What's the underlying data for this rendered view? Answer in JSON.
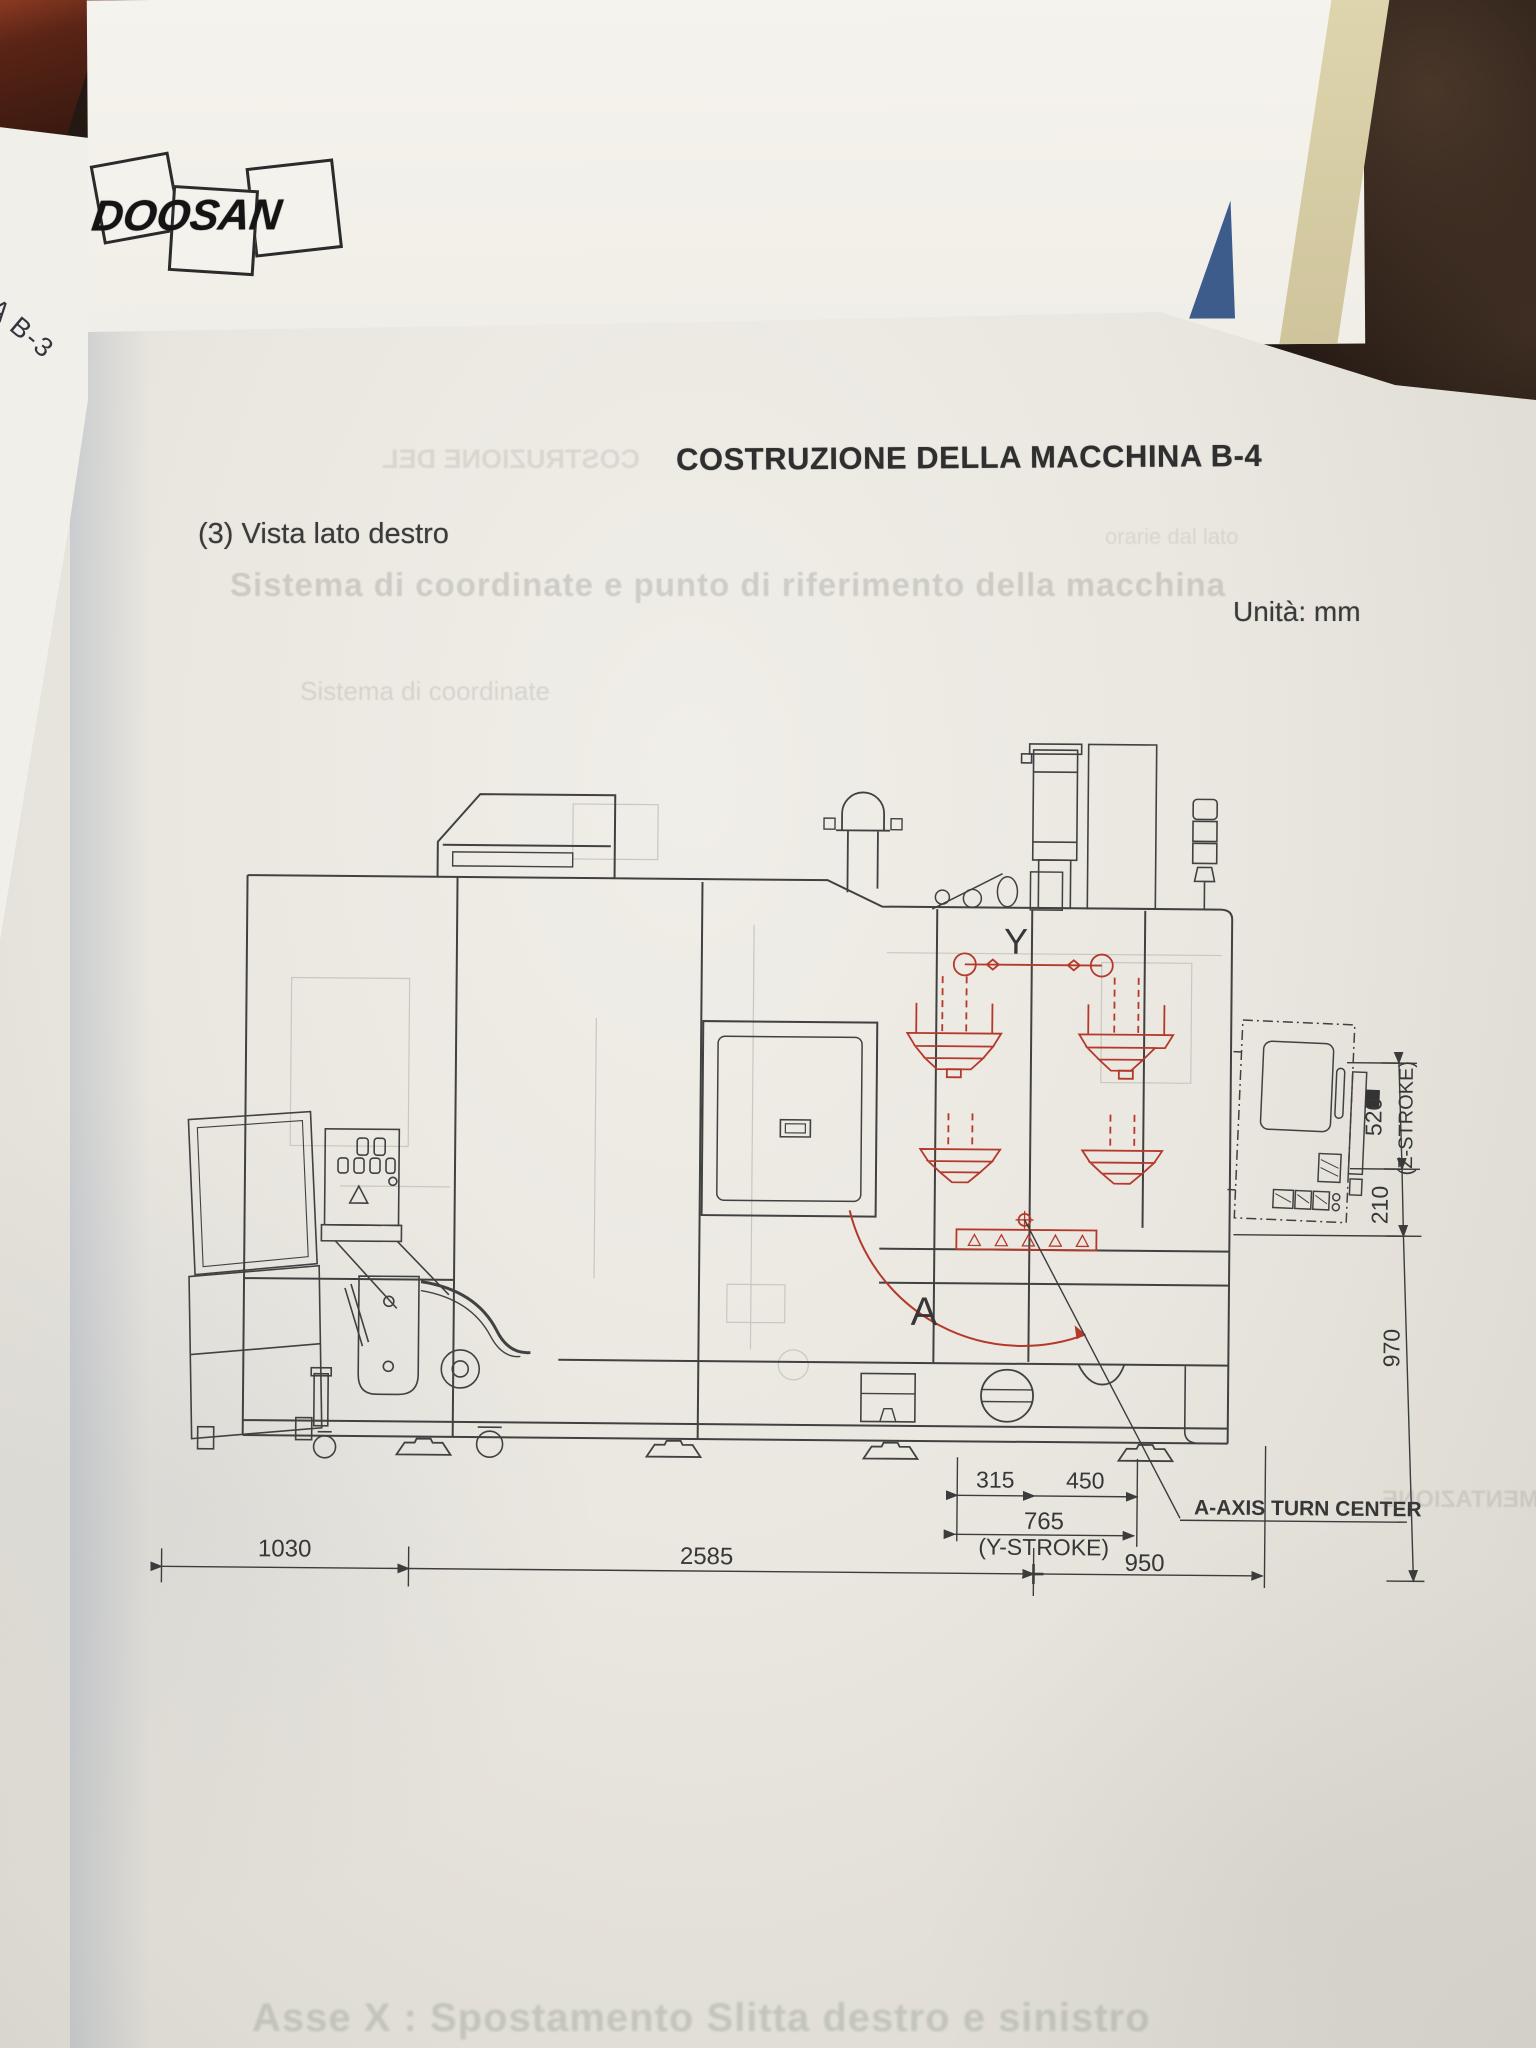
{
  "page": {
    "title": "COSTRUZIONE DELLA MACCHINA B-4",
    "section": "(3) Vista lato destro",
    "units": "Unità: mm",
    "logo": "DOOSAN"
  },
  "drawing": {
    "labels": {
      "y_axis": "Y",
      "a_axis": "A",
      "a_axis_note": "A-AXIS TURN CENTER"
    },
    "dims": {
      "d1030": "1030",
      "d2585": "2585",
      "d950": "950",
      "d315": "315",
      "d450": "450",
      "d765": "765",
      "y_stroke": "(Y-STROKE)",
      "d520": "520",
      "z_stroke": "(Z-STROKE)",
      "d210": "210",
      "d970": "970"
    },
    "colors": {
      "line": "#414141",
      "red_overlay": "#b5392b",
      "triangle_blue": "#3d5c8c"
    }
  },
  "underlay": {
    "spine_text": "HINA B-3",
    "margin_text": "ità: mm"
  },
  "ghosts": {
    "g_intro": "TRODUZIONE",
    "g_title_mirror": "COSTRUZIONE DEL",
    "g_heading": "Sistema di coordinate e punto di riferimento della macchina",
    "g_small": "orarie dal lato",
    "g_sub": "Sistema di coordinate",
    "g_right_mirror": "ALIMENTAZIONE",
    "g_bottom": "Asse X : Spostamento Slitta destro e sinistro"
  }
}
